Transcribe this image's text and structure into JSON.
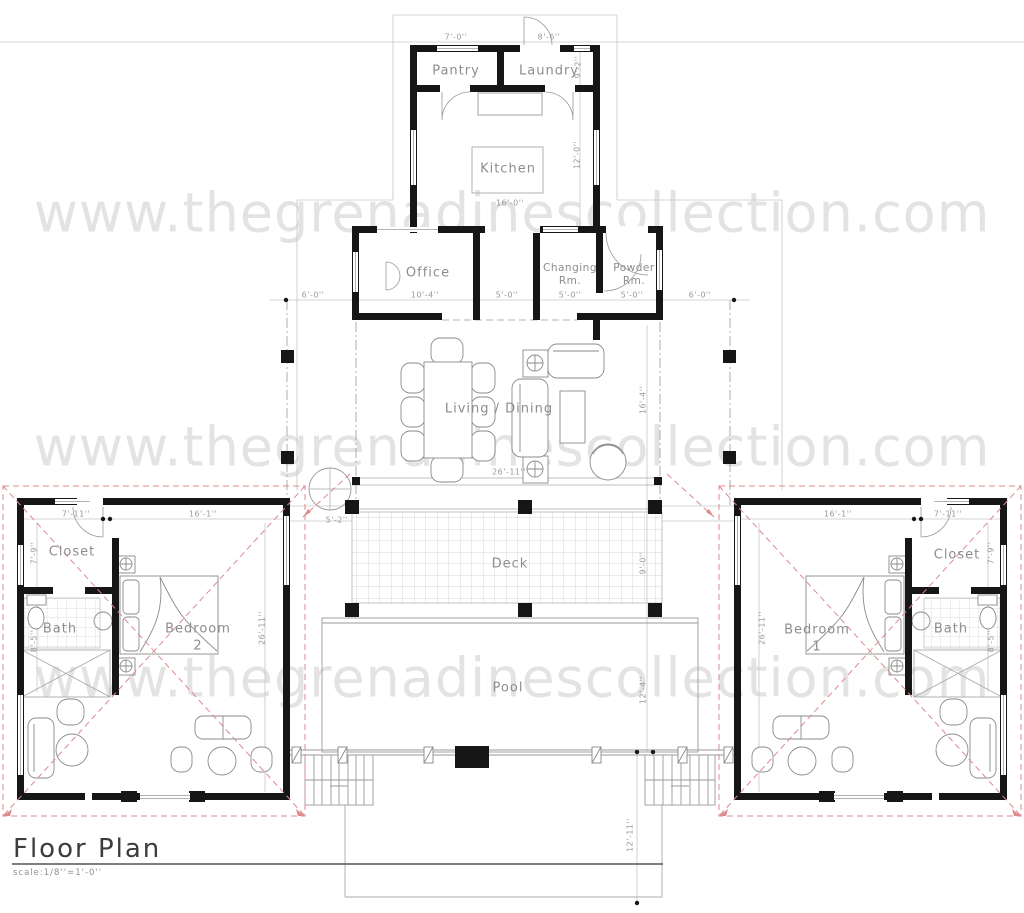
{
  "watermark": {
    "text": "www.thegrenadinescollection.com"
  },
  "title": {
    "label": "Floor Plan",
    "scale": "scale:1/8''=1'-0''"
  },
  "rooms": {
    "pantry": "Pantry",
    "laundry": "Laundry",
    "kitchen": "Kitchen",
    "office": "Office",
    "changing_line1": "Changing",
    "changing_line2": "Rm.",
    "powder_line1": "Powder",
    "powder_line2": "Rm.",
    "living": "Living / Dining",
    "deck": "Deck",
    "pool": "Pool",
    "closet_left": "Closet",
    "bath_left": "Bath",
    "bedroom_left_line1": "Bedroom",
    "bedroom_left_line2": "2",
    "closet_right": "Closet",
    "bath_right": "Bath",
    "bedroom_right_line1": "Bedroom",
    "bedroom_right_line2": "1"
  },
  "dimensions": {
    "pantry_width": "7'-0''",
    "laundry_width": "8'-6''",
    "laundry_height": "9'-2''",
    "kitchen_height": "12'-0''",
    "kitchen_width": "16'-0''",
    "left_porch": "6'-0''",
    "office_width": "10'-4''",
    "hall_width": "5'-0''",
    "changing_width": "5'-0''",
    "powder_width": "5'-0''",
    "right_porch": "6'-0''",
    "living_width": "26'-11''",
    "living_height": "16'-4''",
    "deck_offset": "5'-2''",
    "deck_height": "9'-0''",
    "pool_height": "12'-4''",
    "pool_lower": "12'-11''",
    "left_closet_width": "7'-11''",
    "left_bedroom_width": "16'-1''",
    "left_wing_depth": "26'-11''",
    "left_closet_depth": "7'-9''",
    "left_bath_depth": "8'-5''",
    "right_bedroom_width": "16'-1''",
    "right_closet_width": "7'-11''",
    "right_wing_depth": "26'-11''",
    "right_closet_depth": "7'-9''",
    "right_bath_depth": "8'-5''"
  }
}
